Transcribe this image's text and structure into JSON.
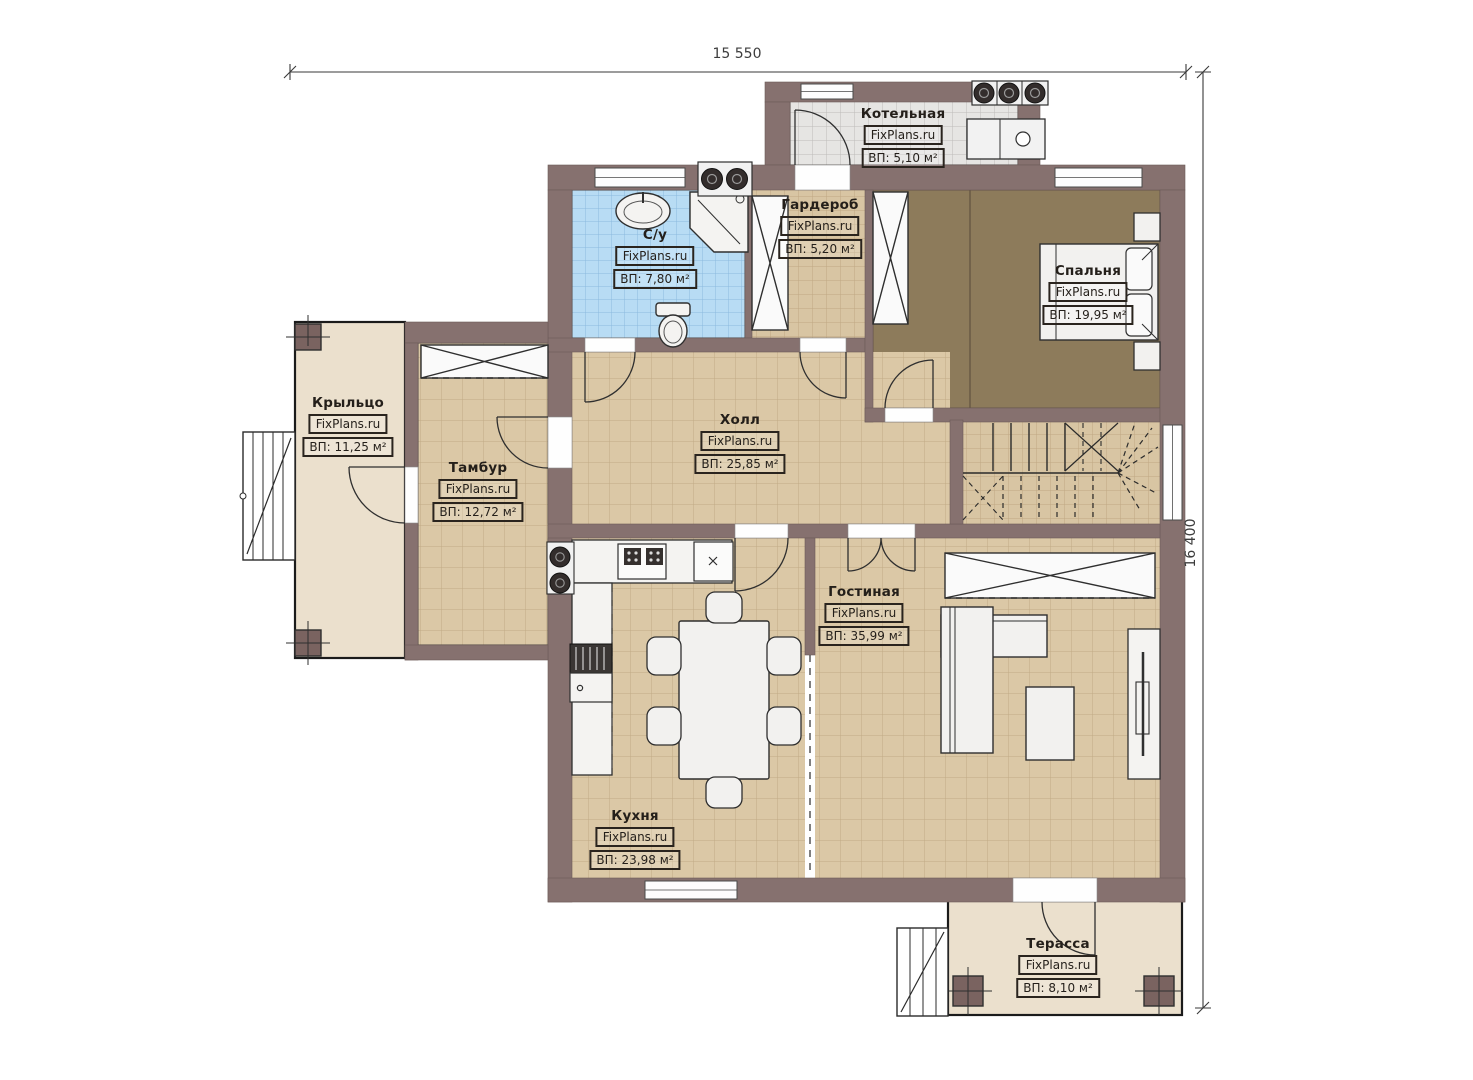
{
  "plan_title": "First floor plan",
  "brand": "FixPlans.ru",
  "dimensions": {
    "width_label": "15 550",
    "height_label": "16 400"
  },
  "palette": {
    "wall": "#86716f",
    "floor_tan": "#dbc8a6",
    "floor_tan_grid": "#a58c63",
    "floor_blue": "#b8dcf4",
    "floor_gray": "#e6e5e3",
    "floor_dark": "#8d7b5b",
    "deck_cream": "#ebe0cd",
    "furniture": "#f2f1ef",
    "line": "#2f2f2f"
  },
  "rooms": {
    "boiler": {
      "name": "Котельная",
      "area": "ВП: 5,10 м²"
    },
    "bathroom": {
      "name": "С/у",
      "area": "ВП: 7,80 м²"
    },
    "wardrobe": {
      "name": "Гардероб",
      "area": "ВП: 5,20 м²"
    },
    "bedroom": {
      "name": "Спальня",
      "area": "ВП: 19,95 м²"
    },
    "porch": {
      "name": "Крыльцо",
      "area": "ВП: 11,25 м²"
    },
    "vestibule": {
      "name": "Тамбур",
      "area": "ВП: 12,72 м²"
    },
    "hall": {
      "name": "Холл",
      "area": "ВП: 25,85 м²"
    },
    "living": {
      "name": "Гостиная",
      "area": "ВП: 35,99 м²"
    },
    "kitchen": {
      "name": "Кухня",
      "area": "ВП: 23,98 м²"
    },
    "terrace": {
      "name": "Терасса",
      "area": "ВП: 8,10 м²"
    }
  }
}
